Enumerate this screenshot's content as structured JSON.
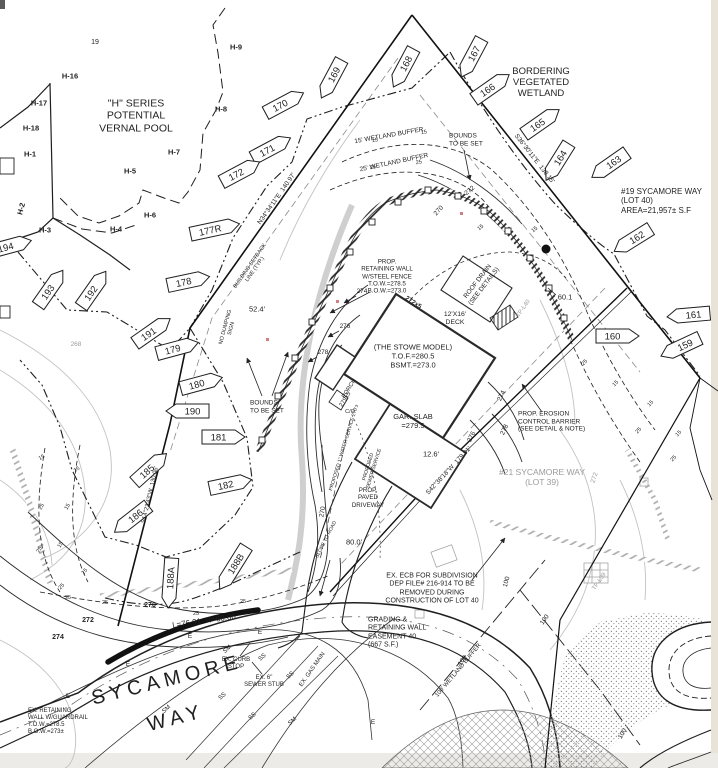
{
  "title": "Plot plan - #19 Sycamore Way (Lot 40)",
  "colors": {
    "ink": "#1f1f1f",
    "gray": "#9b9b9b",
    "paper": "#ffffff",
    "scan_edge_right": "#e9e3d7",
    "scan_edge_bottom": "#edebe7",
    "red_mark": "#d08080"
  },
  "street": {
    "name_line1": "SYCAMORE",
    "name_line2": "WAY"
  },
  "parcel": {
    "lot_label": "#19 SYCAMORE WAY\n(LOT 40)\nAREA=21,957± S.F",
    "neighbor_label": "#21 SYCAMORE WAY\n(LOT 39)",
    "curve_label": "L=76.91  R=60.00"
  },
  "labels": [
    {
      "t": "19",
      "x": 95,
      "y": 43,
      "s": 7,
      "n": "flag-label-19"
    },
    {
      "t": "H-9",
      "x": 236,
      "y": 48,
      "s": 7.5,
      "b": 1,
      "n": "flag-label-h9"
    },
    {
      "t": "H-16",
      "x": 70,
      "y": 77,
      "s": 7.5,
      "b": 1,
      "n": "flag-label-h16"
    },
    {
      "t": "H-17",
      "x": 39,
      "y": 104,
      "s": 7.5,
      "b": 1,
      "n": "flag-label-h17"
    },
    {
      "t": "H-18",
      "x": 31,
      "y": 129,
      "s": 7.5,
      "b": 1,
      "n": "flag-label-h18"
    },
    {
      "t": "H-1",
      "x": 30,
      "y": 155,
      "s": 7.5,
      "b": 1,
      "n": "flag-label-h1"
    },
    {
      "t": "H-2",
      "x": 22,
      "y": 209,
      "r": -75,
      "s": 7.5,
      "b": 1,
      "n": "flag-label-h2"
    },
    {
      "t": "H-3",
      "x": 45,
      "y": 231,
      "s": 7.5,
      "b": 1,
      "n": "flag-label-h3"
    },
    {
      "t": "H-4",
      "x": 116,
      "y": 230,
      "s": 7.5,
      "b": 1,
      "n": "flag-label-h4"
    },
    {
      "t": "H-5",
      "x": 130,
      "y": 172,
      "s": 7.5,
      "b": 1,
      "n": "flag-label-h5"
    },
    {
      "t": "H-6",
      "x": 150,
      "y": 216,
      "s": 7.5,
      "b": 1,
      "n": "flag-label-h6"
    },
    {
      "t": "H-7",
      "x": 174,
      "y": 153,
      "s": 7.5,
      "b": 1,
      "n": "flag-label-h7"
    },
    {
      "t": "H-8",
      "x": 221,
      "y": 110,
      "s": 7.5,
      "b": 1,
      "n": "flag-label-h8"
    },
    {
      "t": "\"H\" SERIES\nPOTENTIAL\nVERNAL POOL",
      "x": 136,
      "y": 116,
      "s": 10.5,
      "n": "vernal-pool-note"
    },
    {
      "t": "BORDERING\nVEGETATED\nWETLAND",
      "x": 541,
      "y": 83,
      "s": 9.5,
      "n": "bvw-note"
    },
    {
      "t": "#19 SYCAMORE WAY\n(LOT 40)\nAREA=21,957± S.F",
      "x": 621,
      "y": 201,
      "s": 8,
      "a": "left",
      "n": "lot40-title"
    },
    {
      "t": "15' WETLAND BUFFER",
      "x": 389,
      "y": 136,
      "r": -10,
      "s": 6.5,
      "n": "buffer15-note"
    },
    {
      "t": "25' WETLAND BUFFER",
      "x": 394,
      "y": 163,
      "r": -12,
      "s": 6.5,
      "n": "buffer25-note"
    },
    {
      "t": "BOUNDS\nTO BE SET",
      "x": 449,
      "y": 140,
      "s": 6.5,
      "a": "left",
      "n": "bounds-note-right"
    },
    {
      "t": "BOUNDS\nTO BE SET",
      "x": 250,
      "y": 407,
      "s": 6.5,
      "a": "left",
      "n": "bounds-note-left"
    },
    {
      "t": "NO DUMPING\nSIGN",
      "x": 229,
      "y": 328,
      "r": -75,
      "s": 5.5,
      "n": "no-dumping-note"
    },
    {
      "t": "52.4'",
      "x": 257,
      "y": 310,
      "s": 7.5,
      "n": "dim-52-4"
    },
    {
      "t": "BUILDING SETBACK\nLINE (TYP.)",
      "x": 253,
      "y": 268,
      "r": -55,
      "s": 5.5,
      "n": "setback-note"
    },
    {
      "t": "N34°34'11\"E  140.97'",
      "x": 277,
      "y": 199,
      "r": -55,
      "s": 6.5,
      "n": "bearing-west"
    },
    {
      "t": "S36°30'11\"E  138.15'",
      "x": 534,
      "y": 159,
      "r": 52,
      "s": 6.5,
      "n": "bearing-east"
    },
    {
      "t": "S42°38'18\"W  179.91'",
      "x": 449,
      "y": 471,
      "r": -47,
      "s": 6.5,
      "n": "bearing-south"
    },
    {
      "t": "S14°23'43\"W  130.06'",
      "x": 151,
      "y": 495,
      "r": -77,
      "s": 6,
      "n": "bearing-southwest"
    },
    {
      "t": "60.1",
      "x": 565,
      "y": 298,
      "s": 7.5,
      "n": "dim-60-1"
    },
    {
      "t": "PROP.\nRETAINING WALL\nW/STEEL FENCE\nT.O.W.=278.5\nB.O.W.=273.0",
      "x": 387,
      "y": 277,
      "s": 6.2,
      "n": "prop-wall-note"
    },
    {
      "t": "ROOF DRAIN\n(SEE DETAILS)",
      "x": 481,
      "y": 284,
      "r": -52,
      "s": 6.5,
      "n": "roof-drain-note"
    },
    {
      "t": "272x5",
      "x": 413,
      "y": 303,
      "r": 33,
      "s": 6.5,
      "b": 1,
      "n": "spot-272-5"
    },
    {
      "t": "12'X16'\nDECK",
      "x": 455,
      "y": 319,
      "s": 6.8,
      "n": "deck-label"
    },
    {
      "t": "(THE STOWE MODEL)\nT.O.F.=280.5\nBSMT.=273.0",
      "x": 413,
      "y": 357,
      "s": 7.5,
      "n": "house-model-label"
    },
    {
      "t": "PORCH",
      "x": 350,
      "y": 389,
      "r": -58,
      "s": 6,
      "n": "porch-label"
    },
    {
      "t": "279x5",
      "x": 346,
      "y": 400,
      "r": -58,
      "s": 6,
      "n": "spot-279-5"
    },
    {
      "t": "C/O",
      "x": 350,
      "y": 412,
      "s": 5.5,
      "n": "cleanout-label"
    },
    {
      "t": "GAR. SLAB\n=279.5",
      "x": 413,
      "y": 422,
      "s": 7.5,
      "n": "garage-slab-label"
    },
    {
      "t": "12.6'",
      "x": 431,
      "y": 455,
      "s": 7.5,
      "n": "dim-12-6"
    },
    {
      "t": "PROP. EROSION\nCONTROL BARRIER\n(SEE DETAIL & NOTE)",
      "x": 518,
      "y": 422,
      "s": 6.5,
      "a": "left",
      "n": "ecb-note"
    },
    {
      "t": "#21 SYCAMORE WAY\n(LOT 39)",
      "x": 542,
      "y": 477,
      "s": 8.5,
      "c": "gray",
      "n": "lot39-title"
    },
    {
      "t": "PROPOSED 1\" WATER SERVICE 270'±",
      "x": 345,
      "y": 448,
      "r": -73,
      "s": 5,
      "n": "water-service-note"
    },
    {
      "t": "PROPOSED\nSEWER SERVICE",
      "x": 372,
      "y": 468,
      "r": -73,
      "s": 5,
      "n": "sewer-service-note"
    },
    {
      "t": "PROP.\nPAVED\nDRIVEWAY",
      "x": 368,
      "y": 498,
      "s": 6.2,
      "n": "driveway-note"
    },
    {
      "t": "SLOPE TO ROAD",
      "x": 327,
      "y": 540,
      "r": -63,
      "s": 5,
      "n": "slope-note"
    },
    {
      "t": "80.0'",
      "x": 354,
      "y": 543,
      "s": 7.5,
      "n": "dim-80-0"
    },
    {
      "t": "EX. ECB FOR SUBDIVISION\nDEP FILE# 216-914 TO BE\nREMOVED DURING\nCONSTRUCTION OF LOT 40",
      "x": 432,
      "y": 589,
      "s": 7,
      "n": "ex-ecb-note"
    },
    {
      "t": "GRADING &\nRETAINING WALL\nEASEMENT 40\n(667 S.F.)",
      "x": 368,
      "y": 633,
      "s": 7,
      "a": "left",
      "n": "easement-note"
    },
    {
      "t": "100' WETLAND BUFFER",
      "x": 459,
      "y": 671,
      "r": -50,
      "s": 6,
      "n": "buffer100-note"
    },
    {
      "t": "EX. GAS MAIN",
      "x": 313,
      "y": 670,
      "r": -55,
      "s": 6,
      "n": "gas-main-note"
    },
    {
      "t": "L=76.91  R=60.00",
      "x": 204,
      "y": 621,
      "r": -8,
      "s": 8,
      "n": "curve-data"
    },
    {
      "t": "EX. CURB\nSTOP",
      "x": 236,
      "y": 664,
      "s": 6,
      "n": "curb-stop-note"
    },
    {
      "t": "EX. 6\"\nSEWER STUB",
      "x": 264,
      "y": 682,
      "s": 6,
      "n": "sewer-stub-note"
    },
    {
      "t": "SYCAMORE",
      "x": 167,
      "y": 681,
      "r": -14,
      "s": 20,
      "sp": 5,
      "n": "street-name-1"
    },
    {
      "t": "WAY",
      "x": 176,
      "y": 719,
      "r": -14,
      "s": 20,
      "sp": 5,
      "n": "street-name-2"
    },
    {
      "t": "EX. RETAINING\nWALL W/GUARDRAIL\nT.O.W.=278.5\nB.O.W.=273±",
      "x": 28,
      "y": 722,
      "s": 6,
      "a": "left",
      "n": "ex-wall-note"
    },
    {
      "t": "270",
      "x": 150,
      "y": 606,
      "s": 7,
      "b": 1,
      "n": "contour-270"
    },
    {
      "t": "272",
      "x": 88,
      "y": 621,
      "s": 7,
      "b": 1,
      "n": "contour-272"
    },
    {
      "t": "274",
      "x": 58,
      "y": 638,
      "s": 7,
      "b": 1,
      "n": "contour-274"
    },
    {
      "t": "270",
      "x": 323,
      "y": 512,
      "r": -80,
      "s": 6.5,
      "n": "contour-270b"
    },
    {
      "t": "268",
      "x": 76,
      "y": 345,
      "s": 6.5,
      "c": "gray",
      "n": "contour-268"
    },
    {
      "t": "270",
      "x": 439,
      "y": 211,
      "r": -48,
      "s": 6.5,
      "n": "contour-270c"
    },
    {
      "t": "272",
      "x": 470,
      "y": 191,
      "r": -40,
      "s": 6.5,
      "n": "contour-272b"
    },
    {
      "t": "274",
      "x": 362,
      "y": 292,
      "s": 6.5,
      "n": "contour-274b"
    },
    {
      "t": "276",
      "x": 345,
      "y": 327,
      "s": 6.5,
      "n": "contour-276"
    },
    {
      "t": "278",
      "x": 323,
      "y": 353,
      "s": 6.5,
      "n": "contour-278"
    },
    {
      "t": "274",
      "x": 502,
      "y": 396,
      "r": -65,
      "s": 6.5,
      "n": "contour-274c"
    },
    {
      "t": "276",
      "x": 472,
      "y": 437,
      "r": -65,
      "s": 6.5,
      "n": "contour-276b"
    },
    {
      "t": "278",
      "x": 505,
      "y": 430,
      "r": -65,
      "s": 6.5,
      "n": "contour-278b"
    },
    {
      "t": "272",
      "x": 595,
      "y": 478,
      "r": -72,
      "s": 6.5,
      "c": "gray",
      "n": "contour-272-gray"
    },
    {
      "t": "TP-L39",
      "x": 600,
      "y": 582,
      "r": -55,
      "s": 6,
      "c": "gray",
      "n": "test-pit-l39"
    },
    {
      "t": "TP-L40",
      "x": 524,
      "y": 309,
      "r": -55,
      "s": 6,
      "c": "gray",
      "n": "test-pit-l40"
    },
    {
      "t": "100",
      "x": 507,
      "y": 582,
      "r": -75,
      "s": 6.5,
      "n": "buffer100-tick-1"
    },
    {
      "t": "100",
      "x": 545,
      "y": 620,
      "r": -55,
      "s": 6.5,
      "n": "buffer100-tick-2"
    },
    {
      "t": "100",
      "x": 463,
      "y": 661,
      "r": -55,
      "s": 6.5,
      "n": "buffer100-tick-3"
    },
    {
      "t": "100",
      "x": 623,
      "y": 734,
      "r": -60,
      "s": 6.5,
      "n": "buffer100-tick-4"
    },
    {
      "t": "15",
      "x": 375,
      "y": 141,
      "r": -10,
      "s": 5.5
    },
    {
      "t": "15",
      "x": 424,
      "y": 133,
      "r": -10,
      "s": 5.5
    },
    {
      "t": "25",
      "x": 373,
      "y": 168,
      "r": -10,
      "s": 5.5
    },
    {
      "t": "25",
      "x": 419,
      "y": 163,
      "r": -10,
      "s": 5.5
    },
    {
      "t": "15",
      "x": 481,
      "y": 228,
      "r": -40,
      "s": 5.5
    },
    {
      "t": "15",
      "x": 535,
      "y": 230,
      "r": -40,
      "s": 5.5
    },
    {
      "t": "25",
      "x": 585,
      "y": 363,
      "r": -45,
      "s": 5.5
    },
    {
      "t": "15",
      "x": 616,
      "y": 384,
      "r": -45,
      "s": 5.5
    },
    {
      "t": "15",
      "x": 651,
      "y": 404,
      "r": -45,
      "s": 5.5
    },
    {
      "t": "25",
      "x": 639,
      "y": 431,
      "r": -45,
      "s": 5.5
    },
    {
      "t": "15",
      "x": 679,
      "y": 434,
      "r": -45,
      "s": 5.5
    },
    {
      "t": "25",
      "x": 674,
      "y": 459,
      "r": -45,
      "s": 5.5
    },
    {
      "t": "25",
      "x": 68,
      "y": 598,
      "s": 5.5
    },
    {
      "t": "25",
      "x": 105,
      "y": 603,
      "s": 5.5
    },
    {
      "t": "25",
      "x": 196,
      "y": 614,
      "s": 5.5
    },
    {
      "t": "25",
      "x": 243,
      "y": 602,
      "s": 5.5
    },
    {
      "t": "15",
      "x": 42,
      "y": 458,
      "r": -30,
      "s": 5.5
    },
    {
      "t": "15",
      "x": 77,
      "y": 470,
      "r": -30,
      "s": 5.5
    },
    {
      "t": "25",
      "x": 42,
      "y": 507,
      "r": -60,
      "s": 5.5
    },
    {
      "t": "15",
      "x": 68,
      "y": 507,
      "r": -60,
      "s": 5.5
    },
    {
      "t": "25",
      "x": 40,
      "y": 550,
      "r": -60,
      "s": 5.5
    },
    {
      "t": "15",
      "x": 61,
      "y": 545,
      "r": -60,
      "s": 5.5
    },
    {
      "t": "15",
      "x": 85,
      "y": 572,
      "r": -45,
      "s": 5.5
    },
    {
      "t": "25",
      "x": 62,
      "y": 587,
      "r": -45,
      "s": 5.5
    },
    {
      "t": "SM",
      "x": 167,
      "y": 710,
      "r": -42,
      "s": 6
    },
    {
      "t": "SM",
      "x": 228,
      "y": 650,
      "r": -42,
      "s": 6
    },
    {
      "t": "SM",
      "x": 293,
      "y": 722,
      "r": -42,
      "s": 6
    },
    {
      "t": "SS",
      "x": 223,
      "y": 697,
      "r": -42,
      "s": 6
    },
    {
      "t": "SS",
      "x": 263,
      "y": 658,
      "r": -42,
      "s": 6
    },
    {
      "t": "SS",
      "x": 291,
      "y": 676,
      "r": -42,
      "s": 6
    },
    {
      "t": "SS",
      "x": 253,
      "y": 717,
      "r": -42,
      "s": 6
    },
    {
      "t": "E",
      "x": 68,
      "y": 697,
      "s": 6.5
    },
    {
      "t": "E",
      "x": 128,
      "y": 665,
      "s": 6.5
    },
    {
      "t": "E",
      "x": 190,
      "y": 637,
      "s": 6.5
    },
    {
      "t": "E",
      "x": 260,
      "y": 633,
      "s": 6.5
    },
    {
      "t": "E",
      "x": 373,
      "y": 723,
      "s": 6.5
    }
  ],
  "wetland_flags": [
    {
      "t": "167",
      "x": 471,
      "y": 58,
      "r": -62,
      "tip": "left"
    },
    {
      "t": "168",
      "x": 403,
      "y": 68,
      "r": -62,
      "tip": "left"
    },
    {
      "t": "169",
      "x": 331,
      "y": 79,
      "r": -62,
      "tip": "left"
    },
    {
      "t": "170",
      "x": 284,
      "y": 103,
      "r": -28,
      "tip": "right"
    },
    {
      "t": "171",
      "x": 271,
      "y": 148,
      "r": -28,
      "tip": "right"
    },
    {
      "t": "172",
      "x": 240,
      "y": 172,
      "r": -28,
      "tip": "right"
    },
    {
      "t": "177R",
      "x": 215,
      "y": 229,
      "r": -12,
      "tip": "right"
    },
    {
      "t": "178",
      "x": 188,
      "y": 281,
      "r": -12,
      "tip": "right"
    },
    {
      "t": "179",
      "x": 177,
      "y": 348,
      "r": -15,
      "tip": "right"
    },
    {
      "t": "180",
      "x": 201,
      "y": 383,
      "r": -15,
      "tip": "right"
    },
    {
      "t": "190",
      "x": 187,
      "y": 411,
      "r": 0,
      "tip": "left"
    },
    {
      "t": "181",
      "x": 223,
      "y": 437,
      "r": 0,
      "tip": "right"
    },
    {
      "t": "182",
      "x": 230,
      "y": 484,
      "r": -12,
      "tip": "right"
    },
    {
      "t": "185",
      "x": 150,
      "y": 468,
      "r": -42,
      "tip": "right"
    },
    {
      "t": "186",
      "x": 131,
      "y": 519,
      "r": -38,
      "tip": "left"
    },
    {
      "t": "188A",
      "x": 170,
      "y": 583,
      "r": -86,
      "tip": "left"
    },
    {
      "t": "188B",
      "x": 233,
      "y": 568,
      "r": -58,
      "tip": "left"
    },
    {
      "t": "191",
      "x": 152,
      "y": 331,
      "r": -35,
      "tip": "right"
    },
    {
      "t": "192",
      "x": 93,
      "y": 289,
      "r": -55,
      "tip": "right"
    },
    {
      "t": "193",
      "x": 50,
      "y": 288,
      "r": -55,
      "tip": "right"
    },
    {
      "t": "194",
      "x": 10,
      "y": 246,
      "r": -15,
      "tip": "right"
    },
    {
      "t": "159",
      "x": 680,
      "y": 347,
      "r": -25,
      "tip": "left"
    },
    {
      "t": "160",
      "x": 617,
      "y": 336,
      "r": 0,
      "tip": "right"
    },
    {
      "t": "161",
      "x": 688,
      "y": 315,
      "r": -5,
      "tip": "left"
    },
    {
      "t": "162",
      "x": 632,
      "y": 240,
      "r": -32,
      "tip": "left"
    },
    {
      "t": "163",
      "x": 609,
      "y": 165,
      "r": -35,
      "tip": "left"
    },
    {
      "t": "164",
      "x": 557,
      "y": 162,
      "r": -58,
      "tip": "left"
    },
    {
      "t": "165",
      "x": 541,
      "y": 122,
      "r": -35,
      "tip": "right"
    },
    {
      "t": "166",
      "x": 491,
      "y": 87,
      "r": -35,
      "tip": "right"
    }
  ]
}
